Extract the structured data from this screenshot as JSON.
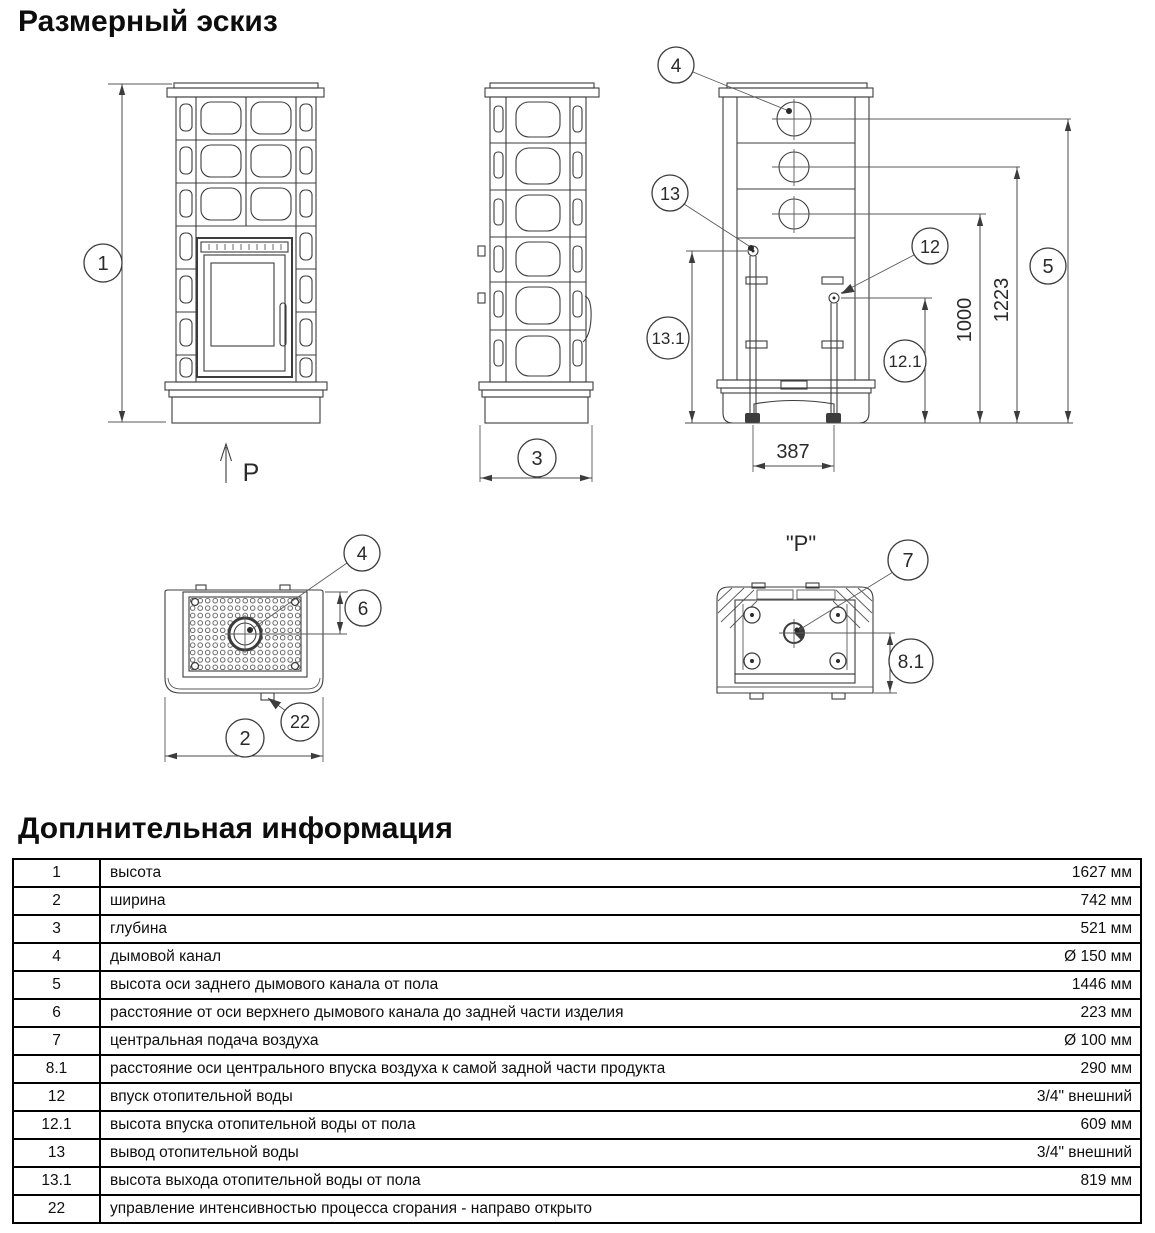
{
  "page": {
    "title": "Размерный эскиз",
    "section2_title": "Доплнительная информация"
  },
  "drawing": {
    "front": {
      "callout_height": "1",
      "direction_label": "P"
    },
    "side": {
      "callout_depth": "3"
    },
    "rear": {
      "callout_flue": "4",
      "callout_water_outlet": "13",
      "callout_water_inlet": "12",
      "callout_water_outlet_height": "13.1",
      "callout_water_inlet_height": "12.1",
      "callout_rear_flue_height": "5",
      "dim_mid_flue": "1223",
      "dim_low_flue": "1000",
      "dim_pipe_spacing": "387"
    },
    "top": {
      "callout_flue": "4",
      "callout_flue_offset": "6",
      "callout_width": "2",
      "callout_damper": "22"
    },
    "bottom": {
      "view_label": "\"P\"",
      "callout_air_inlet": "7",
      "callout_air_offset": "8.1"
    }
  },
  "table": {
    "rows": [
      {
        "num": "1",
        "desc": "высота",
        "value": "1627 мм"
      },
      {
        "num": "2",
        "desc": "ширина",
        "value": "742 мм"
      },
      {
        "num": "3",
        "desc": "глубина",
        "value": "521 мм"
      },
      {
        "num": "4",
        "desc": "дымовой канал",
        "value": "Ø 150 мм"
      },
      {
        "num": "5",
        "desc": "высота оси заднего дымового канала от пола",
        "value": "1446 мм"
      },
      {
        "num": "6",
        "desc": "расстояние от оси верхнего дымового канала до задней части изделия",
        "value": "223 мм"
      },
      {
        "num": "7",
        "desc": "центральная подача воздуха",
        "value": "Ø 100 мм"
      },
      {
        "num": "8.1",
        "desc": "расстояние оси центрального впуска воздуха к самой задной части продукта",
        "value": "290 мм"
      },
      {
        "num": "12",
        "desc": "впуск отопительной воды",
        "value": "3/4\" внешний"
      },
      {
        "num": "12.1",
        "desc": "высота впуска отопительной воды от пола",
        "value": "609 мм"
      },
      {
        "num": "13",
        "desc": "вывод отопительной воды",
        "value": "3/4\" внешний"
      },
      {
        "num": "13.1",
        "desc": "высота выхода отопительной воды от пола",
        "value": "819 мм"
      },
      {
        "num": "22",
        "desc": "управление интенсивностью процесса сгорания - направо открыто",
        "value": ""
      }
    ]
  }
}
